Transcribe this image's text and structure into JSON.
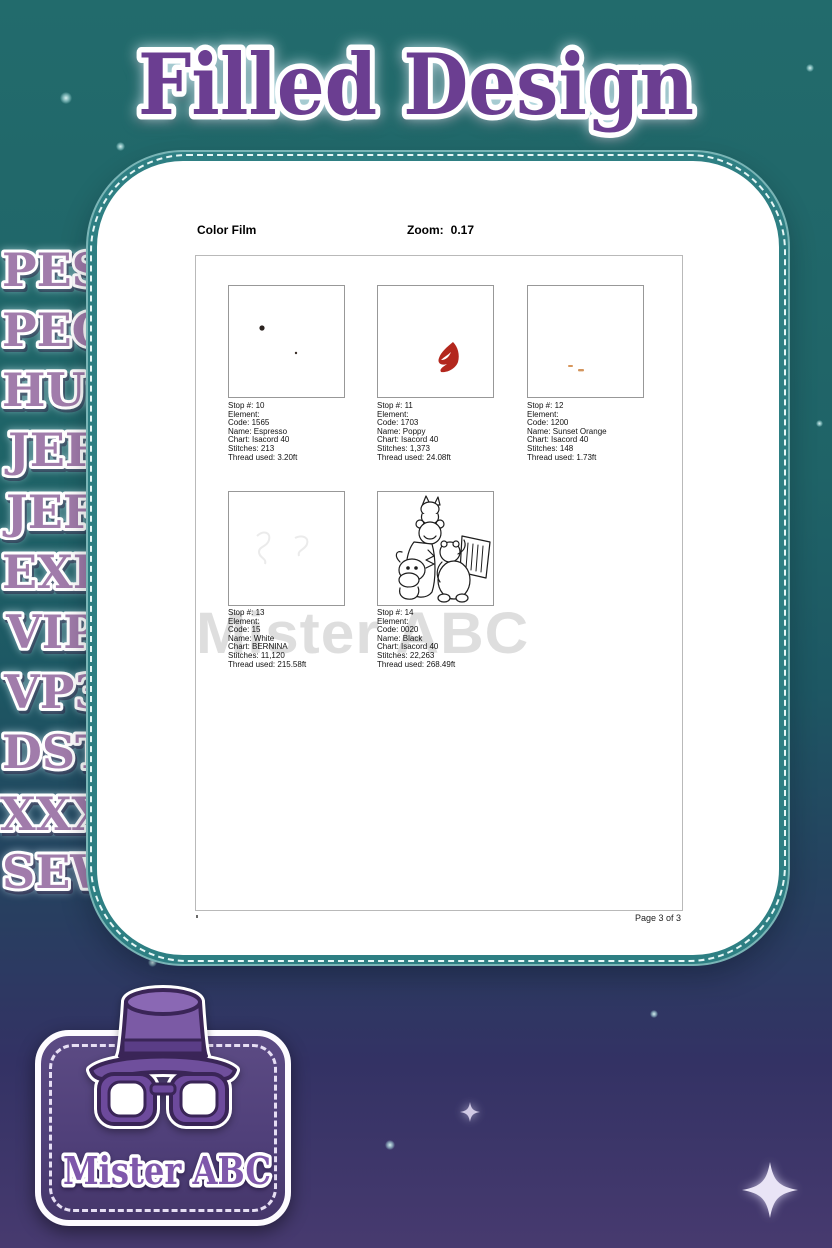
{
  "title": "Filled Design",
  "sidebar": {
    "formats": [
      "PES",
      "PEC",
      "HUS",
      "JEF",
      "JEF+",
      "EXP",
      "VIP",
      "VP3",
      "DST",
      "XXX",
      "SEW"
    ]
  },
  "viewer": {
    "toolbar": {
      "view_name": "Color Film",
      "zoom_label": "Zoom:",
      "zoom_value": "0.17"
    },
    "watermark": "Mister ABC",
    "page_footer": "Page 3 of 3",
    "stops": [
      {
        "lines": [
          "Stop #: 10",
          "Element:",
          "Code: 1565",
          "Name: Espresso",
          "Chart: Isacord 40",
          "Stitches: 213",
          "Thread used: 3.20ft"
        ]
      },
      {
        "lines": [
          "Stop #: 11",
          "Element:",
          "Code: 1703",
          "Name: Poppy",
          "Chart: Isacord 40",
          "Stitches: 1,373",
          "Thread used: 24.08ft"
        ]
      },
      {
        "lines": [
          "Stop #: 12",
          "Element:",
          "Code: 1200",
          "Name: Sunset Orange",
          "Chart: Isacord 40",
          "Stitches: 148",
          "Thread used: 1.73ft"
        ]
      },
      {
        "lines": [
          "Stop #: 13",
          "Element:",
          "Code: 15",
          "Name: White",
          "Chart: BERNINA",
          "Stitches: 11,120",
          "Thread used: 215.58ft"
        ]
      },
      {
        "lines": [
          "Stop #: 14",
          "Element:",
          "Code: 0020",
          "Name: Black",
          "Chart: Isacord 40",
          "Stitches: 22,263",
          "Thread used: 268.49ft"
        ]
      }
    ]
  },
  "logo": {
    "brand": "Mister ABC"
  },
  "colors": {
    "background_teal": "#226b6c",
    "background_purple": "#473a6f",
    "card_border_teal": "#2e7f83",
    "title_purple": "#6b3e91",
    "sidebar_mauve": "#a17cab",
    "logo_purple": "#54427a",
    "poppy_red": "#b3271d",
    "sunset_orange": "#d08540",
    "espresso_dark": "#2b2320",
    "watermark_gray": "#d7d7d7"
  }
}
